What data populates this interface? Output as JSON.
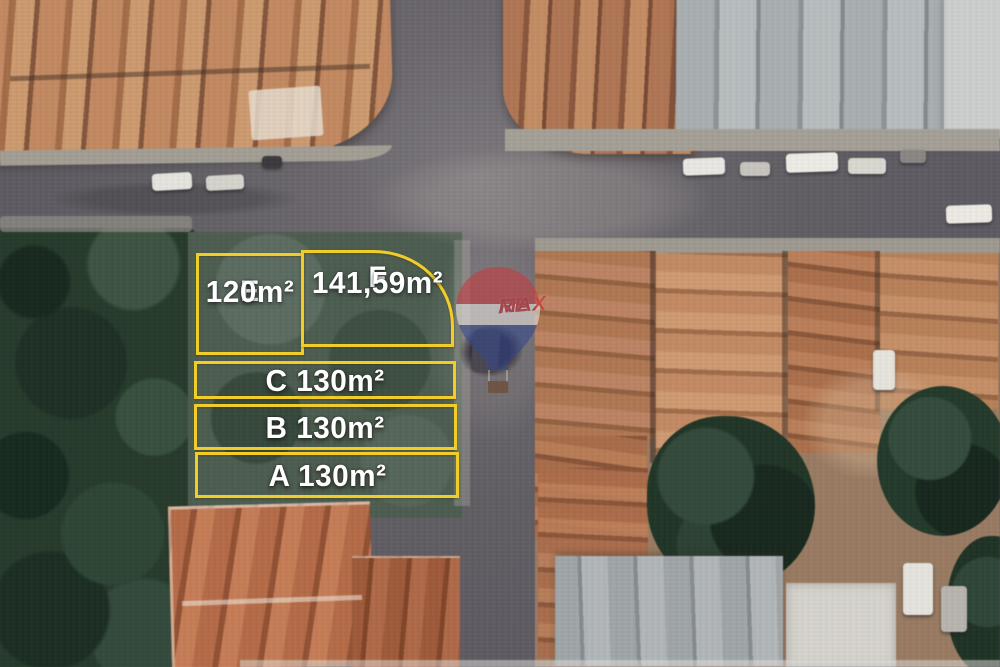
{
  "scene": {
    "kind": "aerial-satellite-real-estate-listing",
    "plot_count": 5
  },
  "colors": {
    "plot_outline": "#f1cd2a",
    "plot_label_text": "#ffffff",
    "remax_red": "#c93a3e",
    "remax_blue": "#35488c",
    "remax_white": "#ece7e2"
  },
  "plots": [
    {
      "id": "E",
      "letter": "E",
      "area": "120m²"
    },
    {
      "id": "F",
      "letter": "F",
      "area": "141,59m²"
    },
    {
      "id": "C",
      "letter": "C",
      "area": "130m²",
      "label": "C 130m²"
    },
    {
      "id": "B",
      "letter": "B",
      "area": "130m²",
      "label": "B 130m²"
    },
    {
      "id": "A",
      "letter": "A",
      "area": "130m²",
      "label": "A 130m²"
    }
  ],
  "watermark": {
    "brand": "RE/MAX",
    "re": "RE",
    "slash": "/",
    "max": "MAX"
  }
}
